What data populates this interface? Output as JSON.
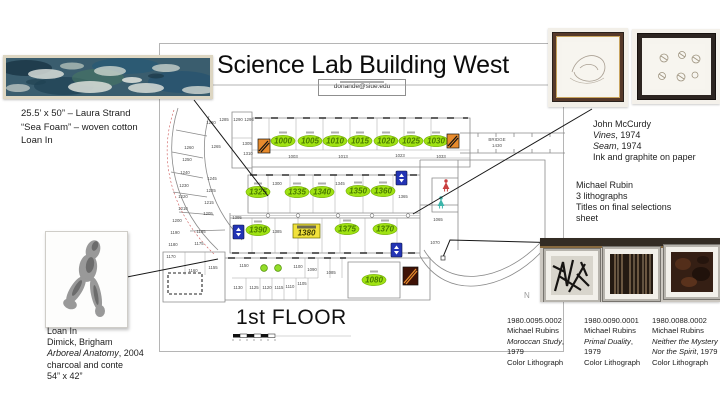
{
  "slide": {
    "title": "Science Lab Building West",
    "email": "donande@siue.edu",
    "floor_label": "1st FLOOR"
  },
  "sea_foam_caption": {
    "line1": "25.5’ x 50” – Laura Strand",
    "line2": "“Sea Foam” – woven cotton",
    "line3": "Loan In"
  },
  "mccurdy": {
    "line1": "John McCurdy",
    "line2_italic": "Vines",
    "line2_rest": ", 1974",
    "line3_italic": "Seam",
    "line3_rest": ", 1974",
    "line4": "Ink and graphite on paper"
  },
  "rubin_note": {
    "line1": "Michael Rubin",
    "line2": "3 lithographs",
    "line3": "Titles on final selections",
    "line4": "sheet"
  },
  "dimick": {
    "line1": "Loan In",
    "line2": "Dimick, Brigham",
    "line3_italic": "Arboreal Anatomy",
    "line3_rest": ", 2004",
    "line4": "charcoal and conte",
    "line5": "54” x 42”"
  },
  "lithographs": [
    {
      "id": "1980.0095.0002",
      "artist": "Michael Rubins",
      "title": "Moroccan Study",
      "year": ", 1979",
      "medium": "Color Lithograph"
    },
    {
      "id": "1980.0090.0001",
      "artist": "Michael Rubins",
      "title": "Primal Duality",
      "year": ", 1979",
      "medium": "Color Lithograph"
    },
    {
      "id": "1980.0088.0002",
      "artist": "Michael Rubins",
      "title": "Neither the Mystery Nor the Spirit",
      "year": ", 1979",
      "medium": "Color Lithograph"
    }
  ],
  "floor_plan": {
    "bridge_label": "BRIDGE",
    "bridge_num": "1430",
    "compass": "N",
    "highlight_color": "#9fe212",
    "box_highlight_color": "#f1e13b",
    "ovals": [
      {
        "n": "1000",
        "x": 283,
        "y": 141
      },
      {
        "n": "1005",
        "x": 310,
        "y": 141
      },
      {
        "n": "1010",
        "x": 335,
        "y": 141
      },
      {
        "n": "1015",
        "x": 360,
        "y": 141
      },
      {
        "n": "1020",
        "x": 386,
        "y": 141
      },
      {
        "n": "1025",
        "x": 411,
        "y": 141
      },
      {
        "n": "1030",
        "x": 436,
        "y": 141
      },
      {
        "n": "1325",
        "x": 258,
        "y": 192
      },
      {
        "n": "1335",
        "x": 297,
        "y": 192
      },
      {
        "n": "1340",
        "x": 322,
        "y": 192
      },
      {
        "n": "1350",
        "x": 358,
        "y": 191
      },
      {
        "n": "1360",
        "x": 383,
        "y": 191
      },
      {
        "n": "1390",
        "x": 258,
        "y": 230
      },
      {
        "n": "1375",
        "x": 347,
        "y": 229
      },
      {
        "n": "1370",
        "x": 385,
        "y": 229
      },
      {
        "n": "1080",
        "x": 374,
        "y": 280
      }
    ],
    "box": {
      "n": "1380",
      "x": 293,
      "y": 224
    },
    "rooms": [
      {
        "n": "1290",
        "x": 238,
        "y": 121
      },
      {
        "n": "1295",
        "x": 249,
        "y": 121
      },
      {
        "n": "1305",
        "x": 247,
        "y": 145
      },
      {
        "n": "1310",
        "x": 248,
        "y": 155
      },
      {
        "n": "1280",
        "x": 211,
        "y": 124
      },
      {
        "n": "1285",
        "x": 224,
        "y": 121
      },
      {
        "n": "1260",
        "x": 189,
        "y": 149
      },
      {
        "n": "1265",
        "x": 216,
        "y": 148
      },
      {
        "n": "1250",
        "x": 187,
        "y": 161
      },
      {
        "n": "1240",
        "x": 185,
        "y": 174
      },
      {
        "n": "1245",
        "x": 212,
        "y": 180
      },
      {
        "n": "1230",
        "x": 184,
        "y": 187
      },
      {
        "n": "1225",
        "x": 211,
        "y": 192
      },
      {
        "n": "1220",
        "x": 183,
        "y": 198
      },
      {
        "n": "1215",
        "x": 209,
        "y": 204
      },
      {
        "n": "1210",
        "x": 183,
        "y": 210
      },
      {
        "n": "1205",
        "x": 208,
        "y": 215
      },
      {
        "n": "1200",
        "x": 177,
        "y": 222
      },
      {
        "n": "1195",
        "x": 201,
        "y": 233
      },
      {
        "n": "1190",
        "x": 175,
        "y": 234
      },
      {
        "n": "1180",
        "x": 173,
        "y": 246
      },
      {
        "n": "1175",
        "x": 199,
        "y": 245
      },
      {
        "n": "1170",
        "x": 171,
        "y": 258
      },
      {
        "n": "1160",
        "x": 193,
        "y": 272
      },
      {
        "n": "1155",
        "x": 213,
        "y": 269
      },
      {
        "n": "1003",
        "x": 293,
        "y": 158
      },
      {
        "n": "1013",
        "x": 343,
        "y": 158
      },
      {
        "n": "1023",
        "x": 400,
        "y": 157
      },
      {
        "n": "1033",
        "x": 441,
        "y": 158
      },
      {
        "n": "1300",
        "x": 277,
        "y": 185
      },
      {
        "n": "1345",
        "x": 340,
        "y": 185
      },
      {
        "n": "1365",
        "x": 403,
        "y": 198
      },
      {
        "n": "1395",
        "x": 237,
        "y": 219
      },
      {
        "n": "1385",
        "x": 277,
        "y": 233
      },
      {
        "n": "1065",
        "x": 438,
        "y": 221
      },
      {
        "n": "1070",
        "x": 435,
        "y": 244
      },
      {
        "n": "1150",
        "x": 244,
        "y": 267
      },
      {
        "n": "1100",
        "x": 298,
        "y": 268
      },
      {
        "n": "1090",
        "x": 312,
        "y": 271
      },
      {
        "n": "1085",
        "x": 331,
        "y": 274
      },
      {
        "n": "1130",
        "x": 238,
        "y": 289
      },
      {
        "n": "1125",
        "x": 254,
        "y": 289
      },
      {
        "n": "1120",
        "x": 267,
        "y": 289
      },
      {
        "n": "1115",
        "x": 279,
        "y": 289
      },
      {
        "n": "1110",
        "x": 290,
        "y": 288
      },
      {
        "n": "1105",
        "x": 302,
        "y": 285
      }
    ],
    "icons": [
      {
        "type": "stairs",
        "x": 258,
        "y": 139
      },
      {
        "type": "stairs",
        "x": 447,
        "y": 134
      },
      {
        "type": "stairs-dark",
        "x": 403,
        "y": 267
      },
      {
        "type": "elevator",
        "x": 396,
        "y": 171
      },
      {
        "type": "elevator",
        "x": 233,
        "y": 225
      },
      {
        "type": "elevator",
        "x": 391,
        "y": 243
      },
      {
        "type": "restroom-women",
        "x": 446,
        "y": 181
      },
      {
        "type": "restroom-men",
        "x": 441,
        "y": 198
      },
      {
        "type": "green-dot",
        "x": 264,
        "y": 268
      },
      {
        "type": "green-dot",
        "x": 278,
        "y": 268
      }
    ]
  }
}
